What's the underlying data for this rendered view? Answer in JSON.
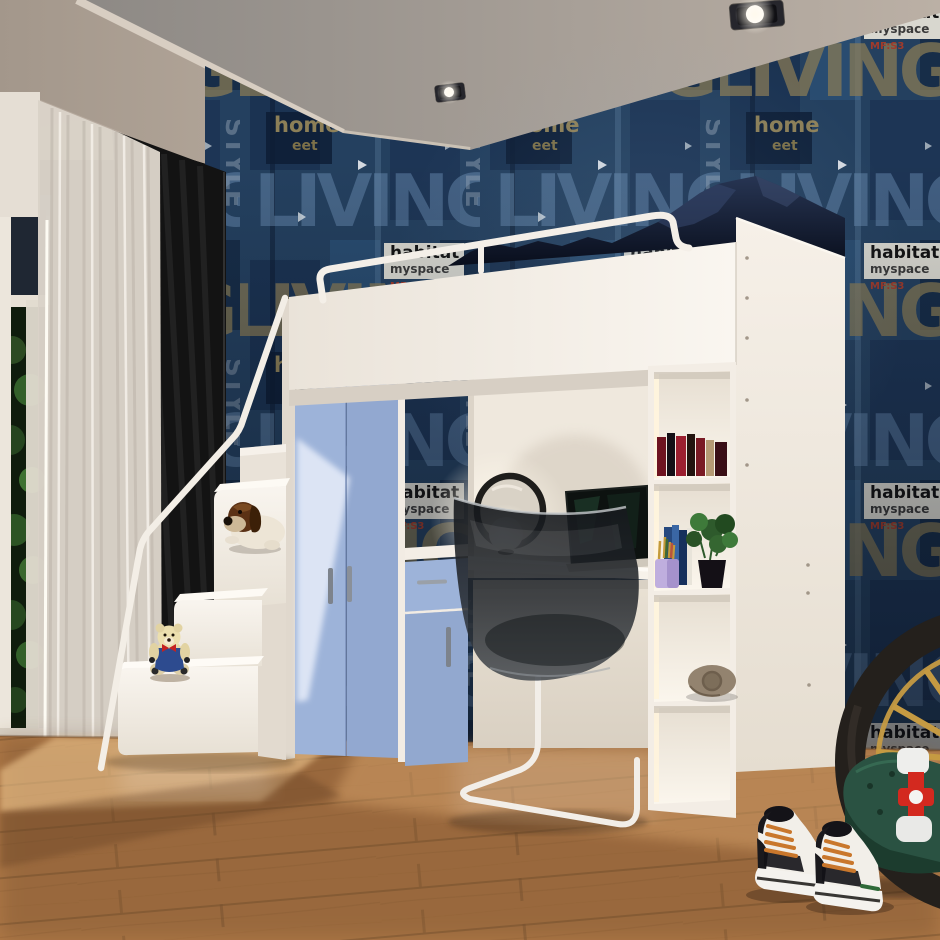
{
  "scene": {
    "description": "3D render of a kids bedroom: white loft bed with safety rail and navy bedding over a desk nook, light-blue wardrobe and cabinet, white cube shelving, white stairs with plush toys, grunge blue wallpaper, wooden floor with sunlight, sneakers, bicycle wheel, green bag and red pump",
    "wallpaper_words": {
      "living": "LIVING",
      "habitat": "habitat",
      "myspace": "myspace",
      "home": "home",
      "eet": "eet",
      "style": "STYLE",
      "mfes": "MF:S3"
    },
    "colors": {
      "wallpaper_base": "#24405f",
      "ceiling_panel": "#b9ada1",
      "ceiling_far": "#948e8a",
      "floor_base": "#b07a48",
      "bed_white": "#f3ede5",
      "wardrobe_blue": "#9db3d9",
      "curtain_black": "#131313",
      "curtain_sheer": "#d9d2c8",
      "bedding_navy": "#141c30",
      "chair_smoke": "#23272c",
      "sneaker_lace": "#c9772c",
      "wheel_gold": "#c59a42",
      "bag_green": "#2a5242",
      "pump_red": "#d3291f"
    },
    "objects": [
      "recessed ceiling spotlights",
      "grunge blue wallpaper",
      "window with greenery",
      "sheer curtain",
      "black curtain",
      "white loft bed with safety rail",
      "navy bedding",
      "blue wardrobe",
      "blue cabinet with drawer",
      "desk with laptop, round mirror and sphere lamp",
      "transparent cantilever chair",
      "cube shelving with books, plant, pencil cup and blanket roll",
      "white stairs with handrail",
      "dog plush",
      "teddy bear plush",
      "wooden floor with sunlight",
      "high-top sneakers",
      "bicycle wheel",
      "green duffel bag",
      "red pump"
    ]
  }
}
